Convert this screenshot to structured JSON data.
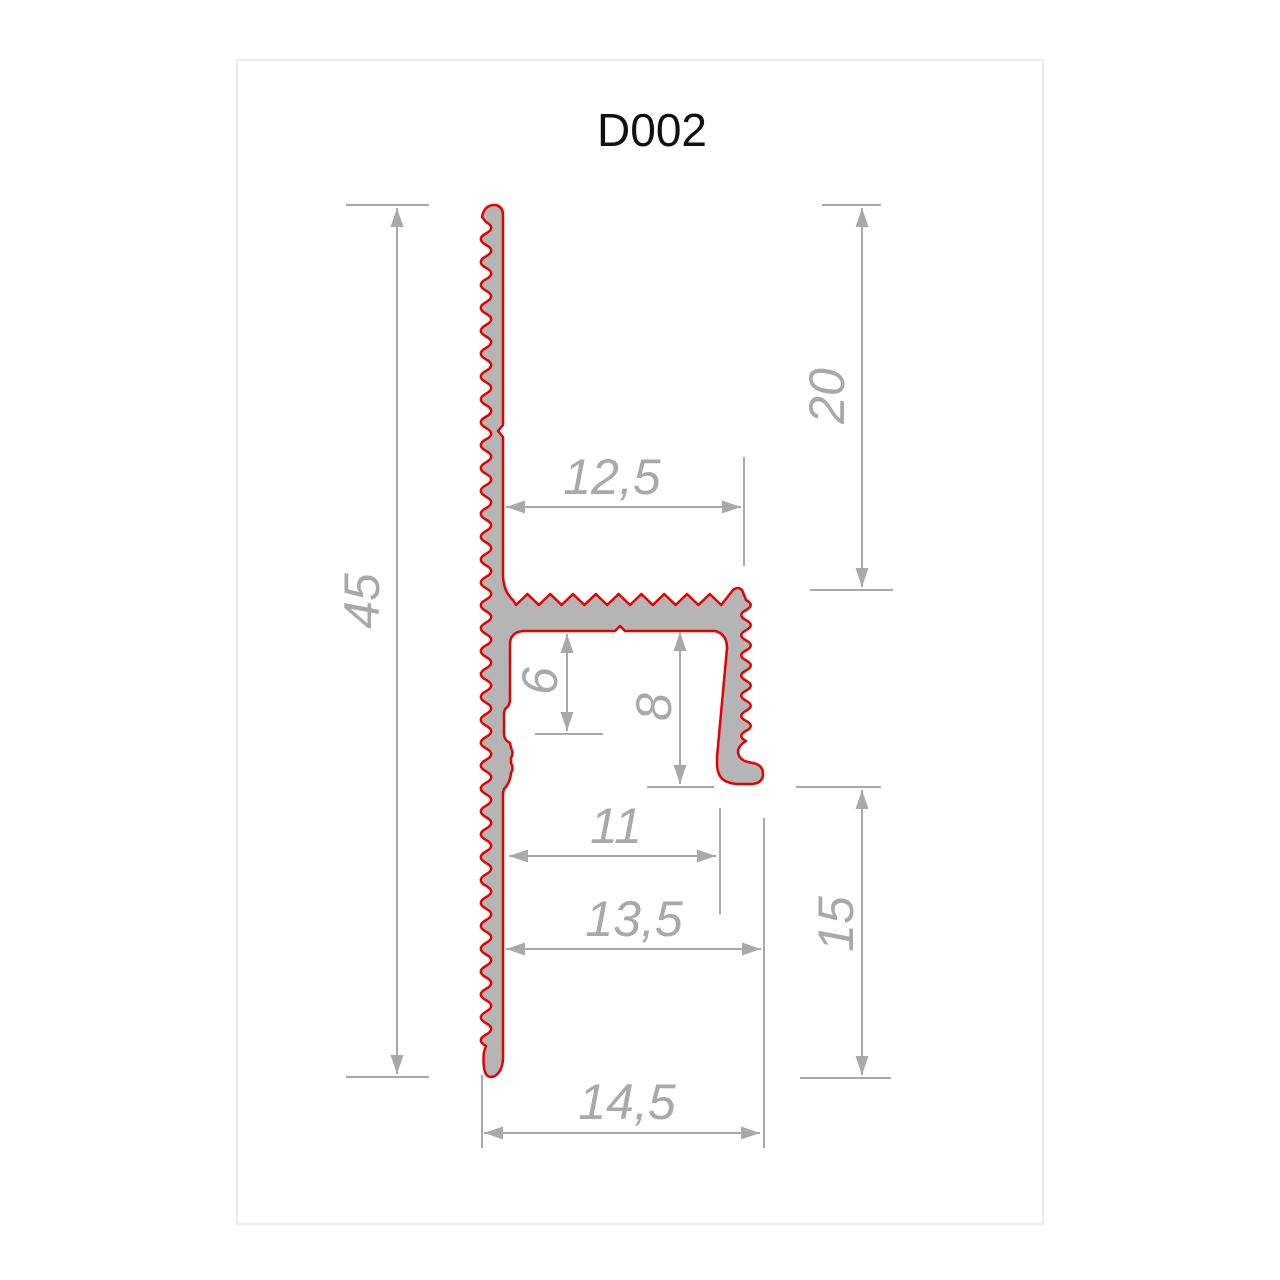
{
  "title": "D002",
  "colors": {
    "profile_fill": "#b5b5b5",
    "profile_outline": "#e60000",
    "dimension": "#a9a9a9",
    "title_text": "#111111",
    "panel_border": "#ededed",
    "background": "#ffffff"
  },
  "dimensions": {
    "total_height": "45",
    "upper_right_height": "20",
    "arm_width": "12,5",
    "inner_step": "6",
    "leg_depth": "8",
    "lower_inner_width": "11",
    "lower_mid_width": "13,5",
    "lower_right_height": "15",
    "base_width": "14,5"
  }
}
